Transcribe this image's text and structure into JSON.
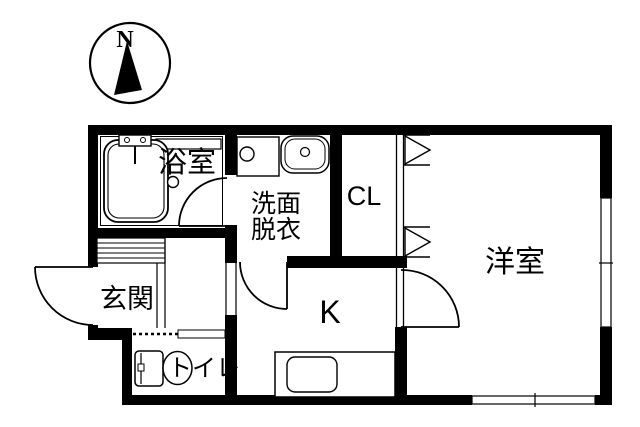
{
  "compass": {
    "label": "N"
  },
  "rooms": {
    "bathroom": {
      "label": "浴室"
    },
    "washroom": {
      "label": "洗面脱衣",
      "line1": "洗面",
      "line2": "脱衣"
    },
    "closet": {
      "label": "CL"
    },
    "western_room": {
      "label": "洋室"
    },
    "entrance": {
      "label": "玄関"
    },
    "kitchen": {
      "label": "K"
    },
    "toilet": {
      "label": "トイレ"
    }
  },
  "colors": {
    "wall": "#000000",
    "background": "#ffffff",
    "line": "#000000"
  }
}
